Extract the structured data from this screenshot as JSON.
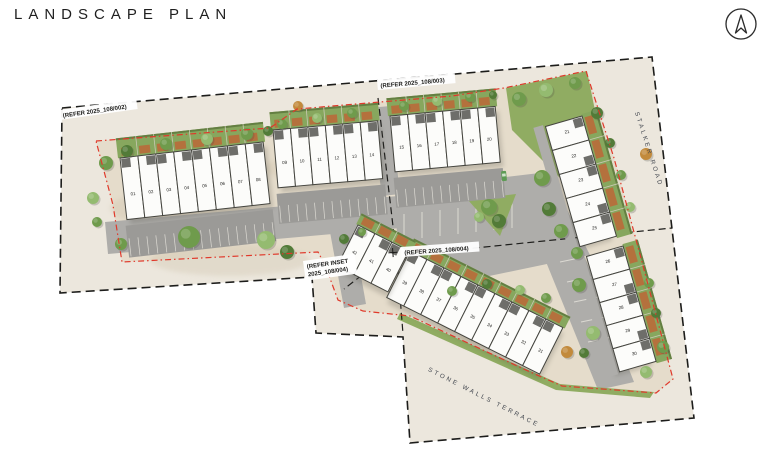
{
  "page": {
    "title": "LANDSCAPE PLAN"
  },
  "north_arrow": {
    "name": "north-arrow"
  },
  "colors": {
    "paper": "#ffffff",
    "outer": "#ece7dd",
    "site": "#e5dccb",
    "asphalt": "#aeadaa",
    "asphalt_dark": "#9b9a97",
    "stripe": "#dcdad3",
    "unit_fill": "#fcfcfa",
    "unit_stroke": "#45453f",
    "porch": "#6e6e6a",
    "patio": "#b4713d",
    "garden": "#87a75e",
    "garden_dark": "#647f42",
    "lawn": "#90ac62",
    "tree_g": "#6f9b4c",
    "tree_d": "#527b38",
    "tree_l": "#94bb70",
    "tree_a": "#c28a3c",
    "red": "#e0392b",
    "black": "#1d1d1b",
    "road_text": "#41464e",
    "car": "#5d9b54"
  },
  "plan": {
    "frame_points": "62,108 652,57 694,418 410,443 403,337 316,333 312,277 60,293",
    "site_points": "96,141 270,128 297,109 452,96 504,88 586,71 614,158 638,247 673,379 656,393 562,386 528,371 410,316 363,311 338,300 325,265 318,252 122,262 113,205",
    "match_lines": [
      "378,98 396,252",
      "396,256 672,228",
      "397,258 403,334",
      "388,255 344,289"
    ],
    "lawns": [
      "506,88 587,71 603,150 560,178 512,130",
      "468,200 516,194 500,236",
      "400,313 560,384 654,392 650,398 556,390 397,319"
    ],
    "roads": [
      "105,222 398,196 401,228 108,254",
      "370,108 390,106 400,194 382,196",
      "395,190 548,172 590,255 470,280 398,258",
      "540,247 578,240 634,382 598,390",
      "330,232 352,226 366,304 344,308"
    ],
    "stripes": [
      "404,214 404,240",
      "422,212 422,238",
      "440,210 440,236",
      "458,208 458,234",
      "476,206 476,232",
      "494,204 494,230",
      "512,202 512,228",
      "560,262 584,257",
      "567,282 591,277",
      "574,302 598,297",
      "581,322 605,317",
      "588,342 612,337"
    ],
    "texture": [
      [
        180,
        208,
        70,
        18
      ],
      [
        320,
        168,
        55,
        14
      ],
      [
        500,
        330,
        60,
        20
      ],
      [
        230,
        260,
        80,
        16
      ]
    ],
    "blocks": [
      {
        "id": "block-plots-01-08",
        "plots": [
          "01",
          "02",
          "03",
          "04",
          "05",
          "06",
          "07",
          "08"
        ],
        "x": 120,
        "y": 158,
        "angle": -6.4,
        "uw": 18,
        "uh": 62,
        "garden": 20,
        "parking": 32,
        "numAt": 0.62
      },
      {
        "id": "block-plots-09-14",
        "plots": [
          "09",
          "10",
          "11",
          "12",
          "13",
          "14"
        ],
        "x": 273,
        "y": 130,
        "angle": -5,
        "uw": 17.5,
        "uh": 58,
        "garden": 18,
        "parking": 30,
        "numAt": 0.6
      },
      {
        "id": "block-plots-15-20",
        "plots": [
          "15",
          "16",
          "17",
          "18",
          "19",
          "20"
        ],
        "x": 390,
        "y": 116,
        "angle": -5.2,
        "uw": 17.6,
        "uh": 56,
        "garden": 18,
        "parking": 30,
        "numAt": 0.6
      },
      {
        "id": "block-plots-21-25",
        "plots": [
          "21",
          "22",
          "23",
          "24",
          "25"
        ],
        "x": 582,
        "y": 116,
        "angle": 74,
        "uw": 25,
        "uh": 38,
        "garden": 16,
        "path": 10,
        "numAt": 0.5,
        "counter": true
      },
      {
        "id": "block-plots-26-30",
        "plots": [
          "26",
          "27",
          "28",
          "29",
          "30"
        ],
        "x": 623,
        "y": 246,
        "angle": 74,
        "uw": 24,
        "uh": 38,
        "garden": 16,
        "path": 10,
        "numAt": 0.5,
        "counter": true
      },
      {
        "id": "block-plots-31-39",
        "plots": [
          "39",
          "38",
          "37",
          "36",
          "35",
          "34",
          "33",
          "32",
          "31"
        ],
        "x": 410,
        "y": 251,
        "angle": 26.6,
        "uw": 19,
        "uh": 52,
        "garden": 13,
        "numAt": 0.62
      },
      {
        "id": "block-plots-40-42",
        "plots": [
          "42",
          "41",
          "40"
        ],
        "x": 358,
        "y": 225,
        "angle": 27,
        "uw": 19,
        "uh": 46,
        "garden": 12,
        "numAt": 0.6
      }
    ],
    "trees": [
      [
        106,
        163,
        7,
        "g"
      ],
      [
        127,
        151,
        6,
        "d"
      ],
      [
        166,
        144,
        6,
        "g"
      ],
      [
        207,
        139,
        6,
        "l"
      ],
      [
        247,
        134,
        6,
        "g"
      ],
      [
        268,
        131,
        5,
        "d"
      ],
      [
        282,
        124,
        5,
        "g"
      ],
      [
        317,
        118,
        5,
        "l"
      ],
      [
        352,
        113,
        5,
        "g"
      ],
      [
        404,
        106,
        5,
        "g"
      ],
      [
        437,
        101,
        5,
        "l"
      ],
      [
        470,
        97,
        5,
        "g"
      ],
      [
        493,
        95,
        4,
        "d"
      ],
      [
        298,
        106,
        5,
        "a"
      ],
      [
        519,
        99,
        7,
        "g"
      ],
      [
        546,
        90,
        7,
        "l"
      ],
      [
        575,
        83,
        6,
        "g"
      ],
      [
        597,
        113,
        6,
        "d"
      ],
      [
        646,
        154,
        6,
        "a"
      ],
      [
        489,
        207,
        8,
        "g"
      ],
      [
        499,
        221,
        7,
        "d"
      ],
      [
        479,
        217,
        5,
        "l"
      ],
      [
        542,
        178,
        8,
        "g"
      ],
      [
        549,
        209,
        7,
        "d"
      ],
      [
        561,
        231,
        7,
        "g"
      ],
      [
        577,
        253,
        6,
        "g"
      ],
      [
        579,
        285,
        7,
        "g"
      ],
      [
        593,
        333,
        7,
        "l"
      ],
      [
        610,
        143,
        5,
        "d"
      ],
      [
        621,
        175,
        5,
        "g"
      ],
      [
        630,
        207,
        5,
        "l"
      ],
      [
        649,
        283,
        5,
        "g"
      ],
      [
        656,
        313,
        5,
        "d"
      ],
      [
        663,
        347,
        6,
        "g"
      ],
      [
        121,
        244,
        6,
        "g"
      ],
      [
        189,
        237,
        11,
        "g"
      ],
      [
        266,
        240,
        9,
        "l"
      ],
      [
        287,
        252,
        7,
        "d"
      ],
      [
        93,
        198,
        6,
        "l"
      ],
      [
        97,
        222,
        5,
        "g"
      ],
      [
        452,
        291,
        5,
        "g"
      ],
      [
        487,
        284,
        5,
        "d"
      ],
      [
        520,
        290,
        5,
        "l"
      ],
      [
        546,
        298,
        5,
        "g"
      ],
      [
        344,
        239,
        5,
        "d"
      ],
      [
        362,
        232,
        4,
        "g"
      ],
      [
        567,
        352,
        6,
        "a"
      ],
      [
        584,
        353,
        5,
        "d"
      ],
      [
        646,
        372,
        6,
        "l"
      ]
    ],
    "car": {
      "x": 504,
      "y": 176,
      "angle": -6
    }
  },
  "labels": {
    "refer_002": {
      "text": "(REFER 2025_108/002)",
      "x": 59,
      "y": 110,
      "angle": -8,
      "w": 78
    },
    "refer_003": {
      "text": "(REFER 2025_108/003)",
      "x": 377,
      "y": 80,
      "angle": -5,
      "w": 78
    },
    "refer_004": {
      "text": "(REFER 2025_108/004)",
      "x": 401,
      "y": 247,
      "angle": -4,
      "w": 78,
      "cross": true
    },
    "refer_inset": {
      "lines": [
        "(REFER INSET",
        "2025_108/004)"
      ],
      "x": 303,
      "y": 261,
      "angle": -8,
      "w": 52
    }
  },
  "road_names": [
    {
      "name": "STALKER ROAD",
      "x": 647,
      "y": 150,
      "angle": 72
    },
    {
      "name": "STONE WALLS TERRACE",
      "x": 483,
      "y": 399,
      "angle": 27
    }
  ]
}
